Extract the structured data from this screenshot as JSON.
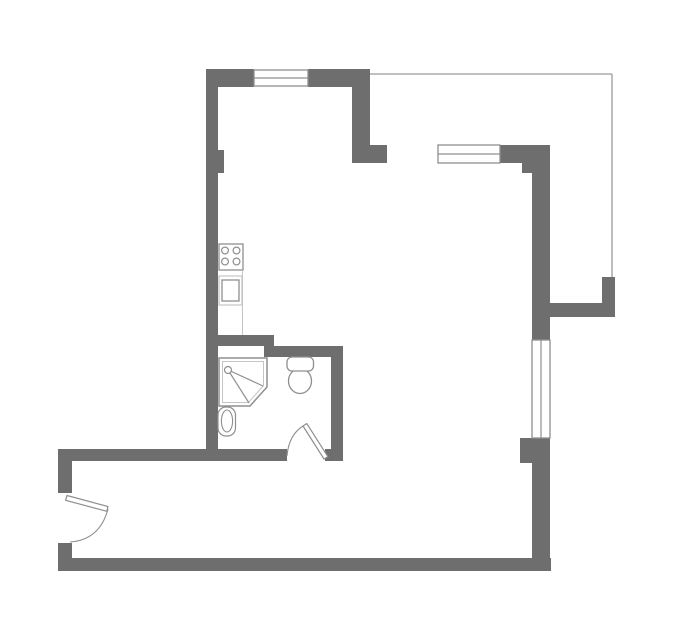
{
  "meta": {
    "type": "apartment-floor-plan",
    "canvas": {
      "width": 679,
      "height": 634
    },
    "background": "#ffffff"
  },
  "palette": {
    "wall": "#6e6e6e",
    "fixture_stroke": "#8f8f8f",
    "light_stroke": "#c4c4c4",
    "boundary_line": "#9a9a9a",
    "floor": "#ffffff"
  },
  "plan": {
    "walls": [
      {
        "name": "wall-left-kitchen",
        "x": 206,
        "y": 69,
        "w": 12,
        "h": 392
      },
      {
        "name": "wall-left-pilaster",
        "x": 218,
        "y": 150,
        "w": 6,
        "h": 23
      },
      {
        "name": "wall-top-left",
        "x": 206,
        "y": 69,
        "w": 48,
        "h": 18
      },
      {
        "name": "wall-top-right",
        "x": 308,
        "y": 69,
        "w": 62,
        "h": 18
      },
      {
        "name": "wall-kitchen-right",
        "x": 352,
        "y": 87,
        "w": 18,
        "h": 76
      },
      {
        "name": "wall-kitchen-foot",
        "x": 370,
        "y": 145,
        "w": 17,
        "h": 18
      },
      {
        "name": "wall-east-top",
        "x": 500,
        "y": 145,
        "w": 50,
        "h": 18
      },
      {
        "name": "wall-east-corner-step",
        "x": 522,
        "y": 163,
        "w": 28,
        "h": 10
      },
      {
        "name": "wall-right-upper",
        "x": 532,
        "y": 173,
        "w": 18,
        "h": 167
      },
      {
        "name": "wall-terrace-jut",
        "x": 550,
        "y": 303,
        "w": 65,
        "h": 14
      },
      {
        "name": "wall-terrace-stub",
        "x": 602,
        "y": 277,
        "w": 13,
        "h": 26
      },
      {
        "name": "wall-right-pier",
        "x": 520,
        "y": 438,
        "w": 30,
        "h": 25
      },
      {
        "name": "wall-right-lower",
        "x": 532,
        "y": 463,
        "w": 18,
        "h": 108
      },
      {
        "name": "wall-bottom",
        "x": 58,
        "y": 558,
        "w": 493,
        "h": 13
      },
      {
        "name": "wall-hall-left-upper",
        "x": 58,
        "y": 449,
        "w": 14,
        "h": 44
      },
      {
        "name": "wall-hall-left-lower",
        "x": 58,
        "y": 543,
        "w": 14,
        "h": 15
      },
      {
        "name": "wall-hall-top",
        "x": 58,
        "y": 449,
        "w": 229,
        "h": 12
      },
      {
        "name": "wall-bathdoor-jamb",
        "x": 325,
        "y": 449,
        "w": 18,
        "h": 12
      },
      {
        "name": "wall-bath-divider-a",
        "x": 206,
        "y": 335,
        "w": 68,
        "h": 11
      },
      {
        "name": "wall-bath-divider-b",
        "x": 264,
        "y": 346,
        "w": 79,
        "h": 11
      },
      {
        "name": "wall-toilet-right",
        "x": 331,
        "y": 346,
        "w": 12,
        "h": 115
      }
    ],
    "windows": [
      {
        "name": "window-north",
        "x": 254,
        "y": 70,
        "w": 54,
        "h": 16,
        "orientation": "h"
      },
      {
        "name": "window-east-upper",
        "x": 438,
        "y": 145,
        "w": 62,
        "h": 18,
        "orientation": "h"
      },
      {
        "name": "window-east",
        "x": 532,
        "y": 340,
        "w": 18,
        "h": 98,
        "orientation": "v"
      }
    ],
    "boundary_lines": [
      {
        "name": "terrace-line-top",
        "x1": 370,
        "y1": 74,
        "x2": 612,
        "y2": 74
      },
      {
        "name": "terrace-line-side",
        "x1": 612,
        "y1": 74,
        "x2": 612,
        "y2": 277
      }
    ],
    "doors": [
      {
        "name": "door-entry",
        "leaf": [
          [
            67,
            495.5
          ],
          [
            108,
            506.5
          ],
          [
            106.7,
            511.3
          ],
          [
            65.7,
            500.3
          ]
        ],
        "arc": "M 108 509 Q 99.7 540 70 542"
      },
      {
        "name": "door-bathroom",
        "leaf": [
          [
            324,
            459
          ],
          [
            303,
            426
          ],
          [
            306.8,
            423.6
          ],
          [
            327.8,
            456.6
          ]
        ],
        "arc": "M 287 456 Q 288.7 435.1 303 426"
      }
    ],
    "fixtures": {
      "stove": {
        "name": "stove-icon",
        "frame": {
          "x": 219,
          "y": 244,
          "w": 24,
          "h": 26
        },
        "burner_radius": 3.4,
        "burners": [
          [
            225,
            250.5
          ],
          [
            236.5,
            250.5
          ],
          [
            225,
            261.5
          ],
          [
            236.5,
            261.5
          ]
        ]
      },
      "oven": {
        "name": "oven-icon",
        "outer": {
          "x": 219,
          "y": 276,
          "w": 23,
          "h": 29
        },
        "inner": {
          "x": 222,
          "y": 280,
          "w": 17,
          "h": 21
        }
      },
      "counter_edge": {
        "name": "counter-edge-line",
        "x1": 242.5,
        "y1": 270,
        "x2": 242.5,
        "y2": 335
      },
      "shower": {
        "name": "shower-icon",
        "outer": [
          [
            219,
            358
          ],
          [
            267,
            358
          ],
          [
            267,
            387
          ],
          [
            250,
            406
          ],
          [
            219,
            406
          ]
        ],
        "inner": [
          [
            222.5,
            361.5
          ],
          [
            263.5,
            361.5
          ],
          [
            263.5,
            385.5
          ],
          [
            248.5,
            402.5
          ],
          [
            222.5,
            402.5
          ]
        ],
        "head": {
          "cx": 228,
          "cy": 370,
          "r": 3.5
        },
        "spray_lines": [
          [
            [
              230,
              373
            ],
            [
              249,
              403
            ]
          ],
          [
            [
              231.5,
              371.5
            ],
            [
              263,
              386
            ]
          ]
        ]
      },
      "sink": {
        "name": "sink-icon",
        "outer": {
          "x": 218,
          "y": 407,
          "w": 17.5,
          "h": 29,
          "rx": 8
        },
        "basin": {
          "cx": 227,
          "cy": 421,
          "rx": 5.6,
          "ry": 11
        }
      },
      "toilet": {
        "name": "toilet-icon",
        "bowl": {
          "cx": 300,
          "cy": 381,
          "rx": 11.5,
          "ry": 12.5
        },
        "tank": {
          "x": 287,
          "y": 357,
          "w": 26.5,
          "h": 14,
          "rx": 5
        }
      }
    }
  }
}
